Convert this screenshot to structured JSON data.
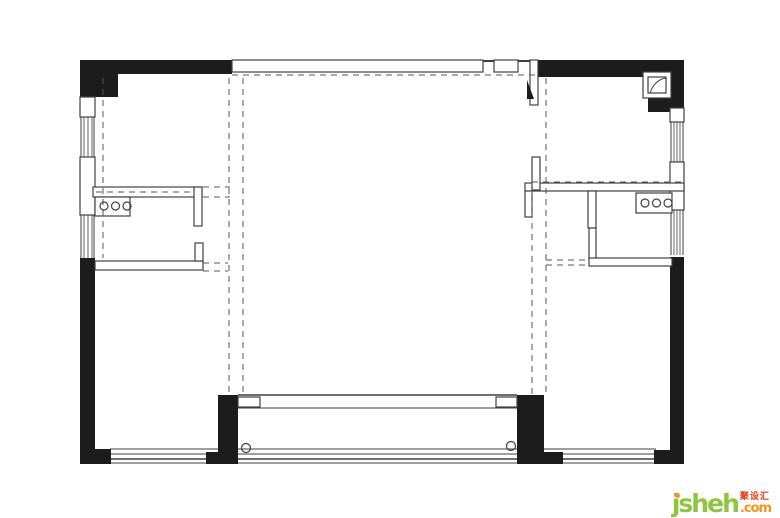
{
  "page": {
    "width": 780,
    "height": 518,
    "background": "#ffffff"
  },
  "watermark": {
    "brand": "jsheh",
    "chinese": "聚设汇",
    "tld": ".com",
    "brand_color": "#8dc63f",
    "chinese_color": "#e8380d",
    "tld_color": "#f7941e",
    "dot_color": "#f7941e"
  },
  "plan": {
    "title": "apartment-floor-plan",
    "ink": "#1c1c1c",
    "line_color": "#3f3f3f",
    "dash_color": "#555555",
    "fill": "#ffffff",
    "lines": [
      [
        232,
        61,
        535,
        61,
        2
      ],
      [
        81,
        97,
        81,
        258,
        1
      ],
      [
        94,
        97,
        94,
        258,
        1
      ],
      [
        84,
        117,
        84,
        157,
        0.8
      ],
      [
        88,
        117,
        88,
        157,
        0.8
      ],
      [
        92,
        117,
        92,
        157,
        0.8
      ],
      [
        84,
        215,
        84,
        258,
        0.8
      ],
      [
        88,
        215,
        88,
        258,
        0.8
      ],
      [
        92,
        215,
        92,
        258,
        0.8
      ],
      [
        671,
        105,
        671,
        255,
        1
      ],
      [
        683,
        105,
        683,
        255,
        1
      ],
      [
        674,
        118,
        674,
        162,
        0.8
      ],
      [
        677,
        118,
        677,
        162,
        0.8
      ],
      [
        680,
        118,
        680,
        162,
        0.8
      ],
      [
        674,
        210,
        674,
        255,
        0.8
      ],
      [
        677,
        210,
        677,
        255,
        0.8
      ],
      [
        680,
        210,
        680,
        255,
        0.8
      ],
      [
        238,
        395,
        517,
        395,
        1.5
      ],
      [
        238,
        408,
        517,
        408,
        1
      ],
      [
        110,
        449,
        218,
        449,
        1
      ],
      [
        110,
        454,
        218,
        454,
        1
      ],
      [
        110,
        459,
        218,
        459,
        1.5
      ],
      [
        110,
        463,
        218,
        463,
        1
      ],
      [
        238,
        449,
        517,
        449,
        1
      ],
      [
        238,
        454,
        517,
        454,
        1
      ],
      [
        238,
        459,
        517,
        459,
        1.5
      ],
      [
        238,
        463,
        517,
        463,
        1
      ],
      [
        544,
        449,
        656,
        449,
        1
      ],
      [
        544,
        454,
        656,
        454,
        1
      ],
      [
        544,
        459,
        656,
        459,
        1.5
      ],
      [
        544,
        463,
        656,
        463,
        1
      ]
    ],
    "solid_rects": [
      [
        80,
        60,
        152,
        14
      ],
      [
        80,
        60,
        38,
        37
      ],
      [
        80,
        258,
        15,
        206
      ],
      [
        95,
        449,
        16,
        15
      ],
      [
        535,
        60,
        149,
        17
      ],
      [
        648,
        60,
        36,
        52
      ],
      [
        670,
        257,
        14,
        207
      ],
      [
        654,
        450,
        16,
        14
      ],
      [
        218,
        395,
        20,
        69
      ],
      [
        206,
        452,
        12,
        12
      ],
      [
        517,
        395,
        27,
        69
      ],
      [
        544,
        452,
        19,
        12
      ]
    ],
    "outlined_rects": [
      [
        80,
        97,
        15,
        20
      ],
      [
        80,
        157,
        15,
        58
      ],
      [
        670,
        108,
        14,
        14
      ],
      [
        670,
        162,
        14,
        48
      ],
      [
        232,
        60,
        251,
        12
      ],
      [
        494,
        60,
        24,
        12
      ],
      [
        93,
        187,
        109,
        10
      ],
      [
        194,
        187,
        8,
        39
      ],
      [
        95,
        197,
        35,
        19
      ],
      [
        95,
        261,
        108,
        9
      ],
      [
        195,
        243,
        8,
        18
      ],
      [
        525,
        183,
        159,
        8
      ],
      [
        525,
        191,
        7,
        26
      ],
      [
        588,
        191,
        8,
        37
      ],
      [
        589,
        228,
        7,
        32
      ],
      [
        589,
        258,
        83,
        8
      ],
      [
        636,
        193,
        36,
        20
      ],
      [
        530,
        60,
        8,
        45
      ],
      [
        532,
        157,
        8,
        33
      ],
      [
        643,
        72,
        28,
        26
      ],
      [
        648,
        77,
        18,
        16
      ],
      [
        238,
        397,
        22,
        10
      ],
      [
        496,
        397,
        21,
        10
      ]
    ],
    "dashed_lines": [
      [
        232,
        75,
        535,
        75
      ],
      [
        103,
        78,
        103,
        258
      ],
      [
        229,
        78,
        229,
        395
      ],
      [
        243,
        78,
        243,
        395
      ],
      [
        532,
        190,
        532,
        395
      ],
      [
        546,
        78,
        546,
        395
      ],
      [
        96,
        192,
        193,
        192
      ],
      [
        203,
        187,
        230,
        187
      ],
      [
        203,
        197,
        230,
        197
      ],
      [
        203,
        263,
        228,
        263
      ],
      [
        203,
        271,
        228,
        271
      ],
      [
        532,
        182,
        683,
        182
      ],
      [
        546,
        260,
        588,
        260
      ],
      [
        546,
        265,
        588,
        265
      ]
    ],
    "triangles": [
      [
        527,
        80,
        534,
        99,
        527,
        99
      ]
    ],
    "circles": [
      [
        104,
        206,
        4
      ],
      [
        115.5,
        206,
        4
      ],
      [
        127,
        206,
        4
      ],
      [
        645,
        203,
        4
      ],
      [
        656.5,
        203,
        4
      ],
      [
        668,
        203,
        4
      ],
      [
        246,
        448,
        4.5
      ],
      [
        511,
        446,
        4.5
      ]
    ],
    "paths": [
      "M 650 93 C 653 84 659 79 666 78"
    ]
  }
}
